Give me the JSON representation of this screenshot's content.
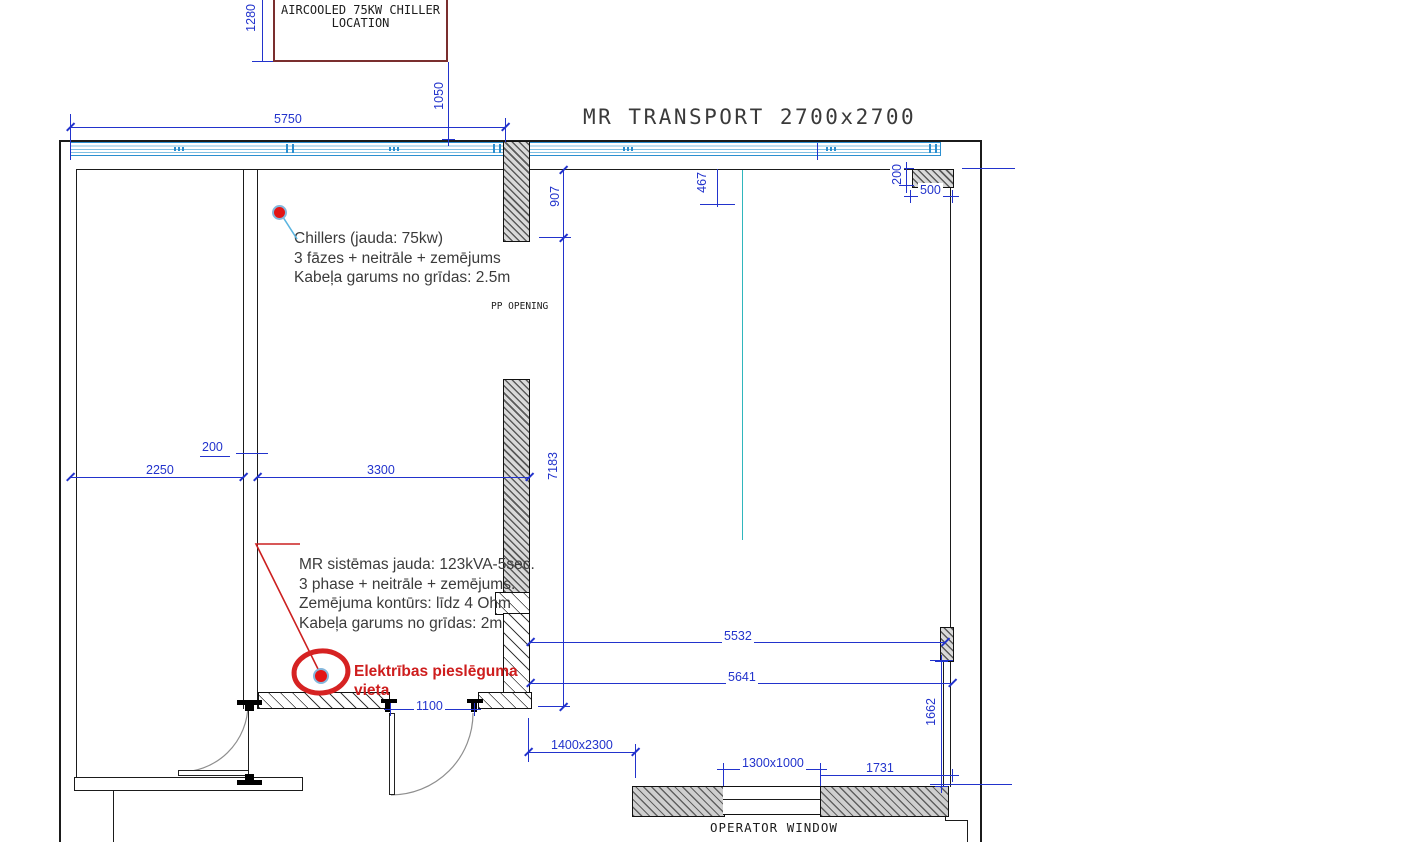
{
  "title": "MR TRANSPORT 2700x2700",
  "chiller_box": {
    "line1": "AIRCOOLED 75KW CHILLER",
    "line2": "LOCATION"
  },
  "labels": {
    "pp_opening": "PP OPENING",
    "operator_window": "OPERATOR WINDOW"
  },
  "annotations": {
    "chiller": {
      "line1": "Chillers (jauda: 75kw)",
      "line2": "3 fāzes + neitrāle + zemējums",
      "line3": "Kabeļa garums no grīdas: 2.5m"
    },
    "power": {
      "line1": "MR sistēmas jauda: 123kVA-5sec.",
      "line2": "3 phase + neitrāle + zemējums.",
      "line3": "Zemējuma kontūrs: līdz 4 Ohm",
      "line4": "Kabeļa garums no grīdas: 2m"
    },
    "electrical": {
      "line1": "Elektrības pieslēguma",
      "line2": "vieta"
    }
  },
  "dimensions": {
    "top_width": "5750",
    "chiller_offset_vertical": "1280",
    "chiller_offset_horizontal": "1050",
    "opening_top": "907",
    "room_height": "7183",
    "column_offset": "467",
    "wall_thickness_top_right": "200",
    "niche_width": "500",
    "room_left_width": "2250",
    "partition_thickness": "200",
    "room_right_width": "3300",
    "span_upper": "5532",
    "span_lower": "5641",
    "right_gap": "1662",
    "door_width": "1100",
    "opening_size": "1400x2300",
    "window_size": "1300x1000",
    "window_offset": "1731"
  },
  "colors": {
    "dimension_blue": "#2233cc",
    "band_blue": "#2b8fd0",
    "centerline_cyan": "#2fb6bd",
    "marker_red": "#d62222",
    "chiller_box_maroon": "#7a2e2e"
  }
}
